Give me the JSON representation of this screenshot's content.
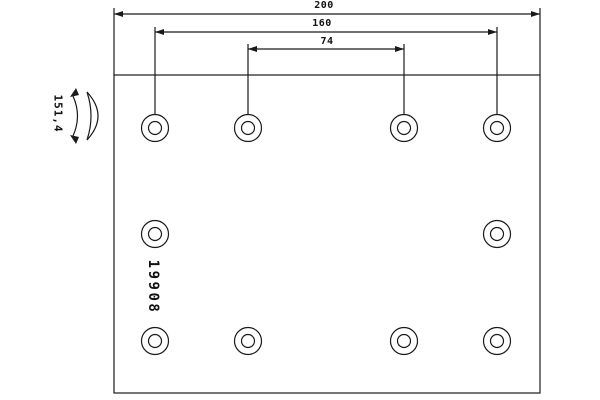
{
  "drawing": {
    "part_number": "19908",
    "dimensions": {
      "total_length": "200",
      "outer_hole_span": "160",
      "inner_hole_span": "74",
      "arc_radius": "151,4"
    }
  },
  "geometry": {
    "plate": {
      "x": 114,
      "y": 75,
      "width": 426,
      "height": 318
    },
    "holes": {
      "outer_radius": 13.5,
      "inner_radius": 6.5,
      "centers": [
        [
          155,
          128
        ],
        [
          248,
          128
        ],
        [
          404,
          128
        ],
        [
          497,
          128
        ],
        [
          155,
          234
        ],
        [
          497,
          234
        ],
        [
          155,
          341
        ],
        [
          248,
          341
        ],
        [
          404,
          341
        ],
        [
          497,
          341
        ]
      ]
    }
  },
  "colors": {
    "line": "#1a1a1a",
    "background": "#ffffff"
  }
}
